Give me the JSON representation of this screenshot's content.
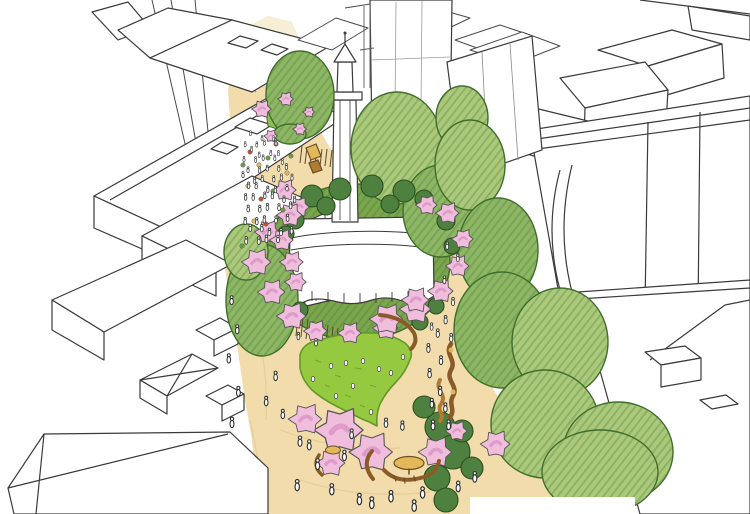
{
  "scene": {
    "kind": "hand-drawn architect's aerial sketch",
    "description": "Artist's impression of a pedestrianised city street: a church with a spire sits in a circular garden of shrubs and pink blossom trees, beside an oval lawn, tan paved plaza with crowds of tiny figures, curved timber benches and play equipment, flanked by sketched white city buildings and large green street trees",
    "elements": [
      "city-buildings",
      "pedestrian-street",
      "church",
      "church-spire",
      "blossom-garden-ring",
      "lawn",
      "street-trees",
      "benches",
      "play-sculpture",
      "people",
      "market-stalls"
    ]
  },
  "palette": {
    "paper": "#ffffff",
    "ink": "#3a3a3a",
    "ink_light": "#6a6a6a",
    "street": "#f2dcab",
    "street_far": "#f8eed6",
    "street_shade": "#dfc48c",
    "verge": "#8fbf54",
    "ring_green": "#7aa64d",
    "lawn": "#95c93f",
    "lawn_stroke": "#64982b",
    "tree_light": "#abc97a",
    "tree_mid": "#8db764",
    "tree_stroke": "#3f6e2c",
    "bush": "#4e8040",
    "bush_stroke": "#2c4f1f",
    "blossom": "#f0bddc",
    "blossom_deep": "#dd9cc9",
    "blossom_stroke": "#555555",
    "bench": "#8a5a28",
    "wood_light": "#b07c33",
    "table_yellow": "#e3b85a",
    "railing": "#5a4a28",
    "figure_fill": "#ffffff",
    "figure_stroke": "#2f2f2f"
  },
  "figures": {
    "people": [
      [
        252,
        138,
        0.55
      ],
      [
        262,
        138,
        0.55
      ],
      [
        272,
        139,
        0.55
      ],
      [
        246,
        146,
        0.58
      ],
      [
        256,
        147,
        0.58
      ],
      [
        266,
        146,
        0.58
      ],
      [
        276,
        147,
        0.58
      ],
      [
        250,
        154,
        0.6
      ],
      [
        260,
        155,
        0.6
      ],
      [
        270,
        154,
        0.6
      ],
      [
        280,
        155,
        0.6
      ],
      [
        244,
        162,
        0.62
      ],
      [
        254,
        163,
        0.62
      ],
      [
        264,
        162,
        0.62
      ],
      [
        274,
        163,
        0.62
      ],
      [
        284,
        162,
        0.62
      ],
      [
        248,
        171,
        0.65
      ],
      [
        258,
        172,
        0.65
      ],
      [
        268,
        171,
        0.65
      ],
      [
        278,
        172,
        0.65
      ],
      [
        288,
        171,
        0.65
      ],
      [
        243,
        180,
        0.68
      ],
      [
        253,
        181,
        0.68
      ],
      [
        263,
        180,
        0.68
      ],
      [
        273,
        181,
        0.68
      ],
      [
        283,
        180,
        0.68
      ],
      [
        292,
        181,
        0.68
      ],
      [
        247,
        190,
        0.7
      ],
      [
        257,
        191,
        0.7
      ],
      [
        267,
        190,
        0.7
      ],
      [
        277,
        191,
        0.7
      ],
      [
        287,
        190,
        0.7
      ],
      [
        244,
        200,
        0.72
      ],
      [
        254,
        201,
        0.72
      ],
      [
        264,
        200,
        0.72
      ],
      [
        274,
        201,
        0.72
      ],
      [
        284,
        200,
        0.72
      ],
      [
        293,
        201,
        0.72
      ],
      [
        249,
        211,
        0.75
      ],
      [
        259,
        212,
        0.75
      ],
      [
        269,
        211,
        0.75
      ],
      [
        279,
        212,
        0.75
      ],
      [
        289,
        211,
        0.75
      ],
      [
        246,
        222,
        0.78
      ],
      [
        256,
        223,
        0.78
      ],
      [
        266,
        222,
        0.78
      ],
      [
        276,
        223,
        0.78
      ],
      [
        286,
        222,
        0.78
      ],
      [
        251,
        233,
        0.8
      ],
      [
        261,
        234,
        0.8
      ],
      [
        271,
        233,
        0.8
      ],
      [
        281,
        234,
        0.8
      ],
      [
        290,
        233,
        0.8
      ],
      [
        247,
        244,
        0.82
      ],
      [
        258,
        245,
        0.82
      ],
      [
        268,
        244,
        0.82
      ],
      [
        278,
        245,
        0.82
      ],
      [
        230,
        302,
        0.95
      ],
      [
        238,
        332,
        0.98
      ],
      [
        228,
        362,
        1.0
      ],
      [
        240,
        396,
        1.05
      ],
      [
        232,
        428,
        1.1
      ],
      [
        274,
        382,
        1.0
      ],
      [
        267,
        408,
        1.02
      ],
      [
        282,
        416,
        1.0
      ],
      [
        300,
        338,
        0.8
      ],
      [
        316,
        345,
        0.8
      ],
      [
        430,
        330,
        0.8
      ],
      [
        448,
        250,
        0.8
      ],
      [
        457,
        263,
        0.82
      ],
      [
        446,
        286,
        0.85
      ],
      [
        453,
        303,
        0.88
      ],
      [
        444,
        322,
        0.9
      ],
      [
        452,
        341,
        0.92
      ],
      [
        437,
        337,
        0.9
      ],
      [
        430,
        353,
        0.95
      ],
      [
        441,
        366,
        0.95
      ],
      [
        428,
        380,
        1.0
      ],
      [
        441,
        393,
        1.0
      ],
      [
        431,
        406,
        1.02
      ],
      [
        447,
        411,
        1.0
      ],
      [
        300,
        446,
        1.1
      ],
      [
        316,
        470,
        1.15
      ],
      [
        298,
        492,
        1.2
      ],
      [
        331,
        497,
        1.2
      ],
      [
        361,
        502,
        1.22
      ],
      [
        391,
        500,
        1.22
      ],
      [
        421,
        497,
        1.2
      ],
      [
        415,
        511,
        1.22
      ],
      [
        371,
        509,
        1.25
      ],
      [
        346,
        462,
        1.12
      ],
      [
        433,
        432,
        1.05
      ],
      [
        447,
        427,
        1.05
      ],
      [
        459,
        490,
        1.15
      ],
      [
        474,
        481,
        1.12
      ],
      [
        404,
        430,
        1.0
      ],
      [
        386,
        428,
        1.0
      ],
      [
        350,
        440,
        1.05
      ],
      [
        310,
        452,
        1.08
      ]
    ],
    "birds": [
      [
        331,
        366
      ],
      [
        346,
        363
      ],
      [
        363,
        361
      ],
      [
        379,
        369
      ],
      [
        353,
        386
      ],
      [
        336,
        396
      ],
      [
        313,
        379
      ],
      [
        371,
        412
      ],
      [
        391,
        373
      ],
      [
        403,
        357
      ]
    ],
    "blossoms": [
      [
        268,
        232,
        13
      ],
      [
        257,
        262,
        15
      ],
      [
        272,
        292,
        14
      ],
      [
        292,
        316,
        15
      ],
      [
        316,
        331,
        12
      ],
      [
        350,
        333,
        12
      ],
      [
        386,
        328,
        13
      ],
      [
        416,
        309,
        16
      ],
      [
        441,
        291,
        13
      ],
      [
        458,
        266,
        12
      ],
      [
        463,
        239,
        11
      ],
      [
        448,
        213,
        12
      ],
      [
        299,
        207,
        11
      ],
      [
        427,
        205,
        11
      ],
      [
        262,
        109,
        10
      ],
      [
        286,
        99,
        8
      ],
      [
        300,
        129,
        7
      ],
      [
        271,
        136,
        7
      ],
      [
        309,
        112,
        6
      ],
      [
        285,
        190,
        12
      ],
      [
        290,
        215,
        13
      ],
      [
        282,
        240,
        12
      ],
      [
        292,
        262,
        12
      ],
      [
        296,
        282,
        11
      ],
      [
        387,
        319,
        17
      ],
      [
        416,
        300,
        14
      ],
      [
        340,
        430,
        25
      ],
      [
        306,
        419,
        17
      ],
      [
        372,
        452,
        22
      ],
      [
        331,
        463,
        15
      ],
      [
        436,
        452,
        17
      ],
      [
        457,
        431,
        11
      ],
      [
        496,
        444,
        15
      ]
    ],
    "canopies": [
      [
        300,
        95,
        34,
        44,
        "mid"
      ],
      [
        397,
        148,
        46,
        56,
        "light"
      ],
      [
        441,
        211,
        38,
        46,
        "mid"
      ],
      [
        462,
        118,
        26,
        32,
        "light"
      ],
      [
        470,
        165,
        35,
        45,
        "light"
      ],
      [
        498,
        250,
        40,
        52,
        "mid"
      ],
      [
        502,
        330,
        48,
        58,
        "mid"
      ],
      [
        560,
        342,
        48,
        54,
        "light"
      ],
      [
        545,
        424,
        54,
        54,
        "light"
      ],
      [
        618,
        452,
        55,
        50,
        "light"
      ],
      [
        600,
        472,
        58,
        42,
        "light"
      ],
      [
        262,
        300,
        36,
        56,
        "mid"
      ],
      [
        246,
        252,
        22,
        28,
        "light"
      ],
      [
        290,
        134,
        16,
        10,
        "mid"
      ]
    ],
    "bushes": [
      [
        440,
        427,
        15
      ],
      [
        453,
        452,
        17
      ],
      [
        437,
        478,
        13
      ],
      [
        424,
        407,
        11
      ],
      [
        462,
        431,
        11
      ],
      [
        446,
        500,
        12
      ],
      [
        472,
        468,
        11
      ],
      [
        312,
        196,
        11
      ],
      [
        340,
        189,
        11
      ],
      [
        372,
        186,
        11
      ],
      [
        404,
        191,
        11
      ],
      [
        326,
        206,
        9
      ],
      [
        390,
        204,
        9
      ],
      [
        424,
        199,
        9
      ],
      [
        295,
        220,
        9
      ],
      [
        446,
        221,
        9
      ],
      [
        286,
        234,
        8
      ],
      [
        452,
        246,
        8
      ],
      [
        300,
        310,
        8
      ],
      [
        436,
        306,
        8
      ],
      [
        420,
        322,
        8
      ]
    ],
    "market_dots": [
      [
        250,
        152,
        "#cf4b3a"
      ],
      [
        259,
        165,
        "#e3b85a"
      ],
      [
        268,
        158,
        "#6f9e44"
      ],
      [
        248,
        186,
        "#e3b85a"
      ],
      [
        261,
        199,
        "#cf4b3a"
      ],
      [
        273,
        191,
        "#6f9e44"
      ],
      [
        254,
        221,
        "#e3b85a"
      ],
      [
        266,
        224,
        "#cf4b3a"
      ],
      [
        287,
        173,
        "#e3b85a"
      ],
      [
        283,
        210,
        "#6f9e44"
      ],
      [
        276,
        144,
        "#cf4b3a"
      ],
      [
        291,
        156,
        "#6f9e44"
      ],
      [
        243,
        165,
        "#6f9e44"
      ],
      [
        242,
        246,
        "#6f9e44"
      ]
    ]
  }
}
